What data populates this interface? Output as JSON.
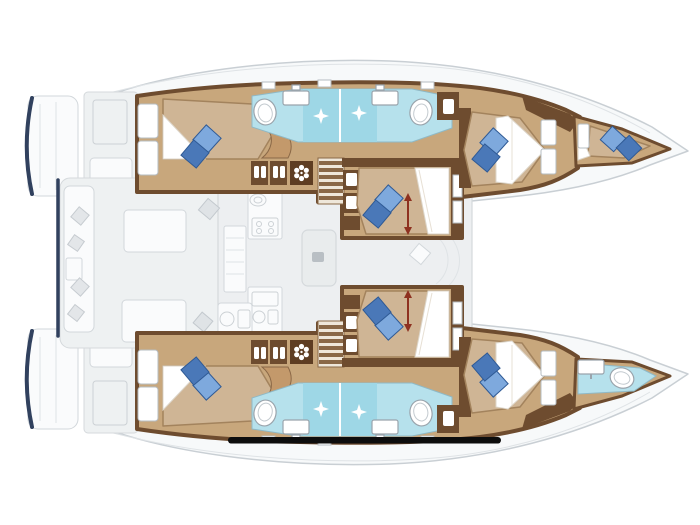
{
  "plan": {
    "type": "catamaran deck plan",
    "orientation": "bow right, stern left",
    "hull_count": 2,
    "cabins": [
      {
        "id": "port-aft-cabin",
        "bed": "double",
        "pillows": 2
      },
      {
        "id": "port-mid-cabin",
        "bed": "double",
        "pillows": 2,
        "length_arrow": true
      },
      {
        "id": "port-forward-cabin",
        "bed": "double",
        "pillows": 2
      },
      {
        "id": "starboard-aft-cabin",
        "bed": "double",
        "pillows": 2
      },
      {
        "id": "starboard-mid-cabin",
        "bed": "double",
        "pillows": 2,
        "length_arrow": true
      },
      {
        "id": "starboard-forward-cabin",
        "bed": "double",
        "pillows": 2
      },
      {
        "id": "bow-crew-berth",
        "bed": "single",
        "pillows": 2
      }
    ],
    "bathrooms": [
      {
        "id": "port-aft-bathroom",
        "fixtures": [
          "toilet",
          "sink",
          "shower"
        ]
      },
      {
        "id": "port-forward-bathroom",
        "fixtures": [
          "toilet",
          "sink",
          "shower"
        ]
      },
      {
        "id": "starboard-aft-bathroom",
        "fixtures": [
          "toilet",
          "sink",
          "shower"
        ]
      },
      {
        "id": "starboard-forward-bathroom",
        "fixtures": [
          "toilet",
          "sink",
          "shower"
        ]
      },
      {
        "id": "bow-bathroom",
        "fixtures": [
          "toilet",
          "sink"
        ]
      }
    ],
    "interior_features": [
      "wardrobes",
      "fan-unit",
      "companionway-stairs",
      "galley-sink",
      "stove",
      "salon-table",
      "nightstands"
    ],
    "exterior_features": [
      "swim-platforms",
      "stern-steps",
      "cockpit-bench-cushions",
      "cockpit-tables",
      "outdoor-galley",
      "foredeck"
    ],
    "scale_bar": {
      "present": true
    }
  },
  "colors": {
    "hull_floor": "#c8a77c",
    "bed_duvet": "#cfb595",
    "wood_dark": "#6e4c2f",
    "wood_mid": "#8a6847",
    "wood_light": "#c3996b",
    "pillow_light": "#7ea9dd",
    "pillow_dark": "#4a78b8",
    "pillow_stroke": "#2f5a95",
    "bath_floor": "#b6e1ec",
    "bath_shower": "#9ed7e6",
    "fixture_stroke": "#9aa4ac",
    "exterior_fill": "#f7f9fa",
    "exterior_line": "#c9cfd4",
    "deck_fill": "#eef1f2",
    "salon_fill": "#edeff1",
    "salon_line": "#d5d9dc",
    "cushion_gray": "#e3e6e9",
    "navy": "#31415e",
    "arrow_red": "#8e3120",
    "scale_bar": "#0d0d0d"
  }
}
